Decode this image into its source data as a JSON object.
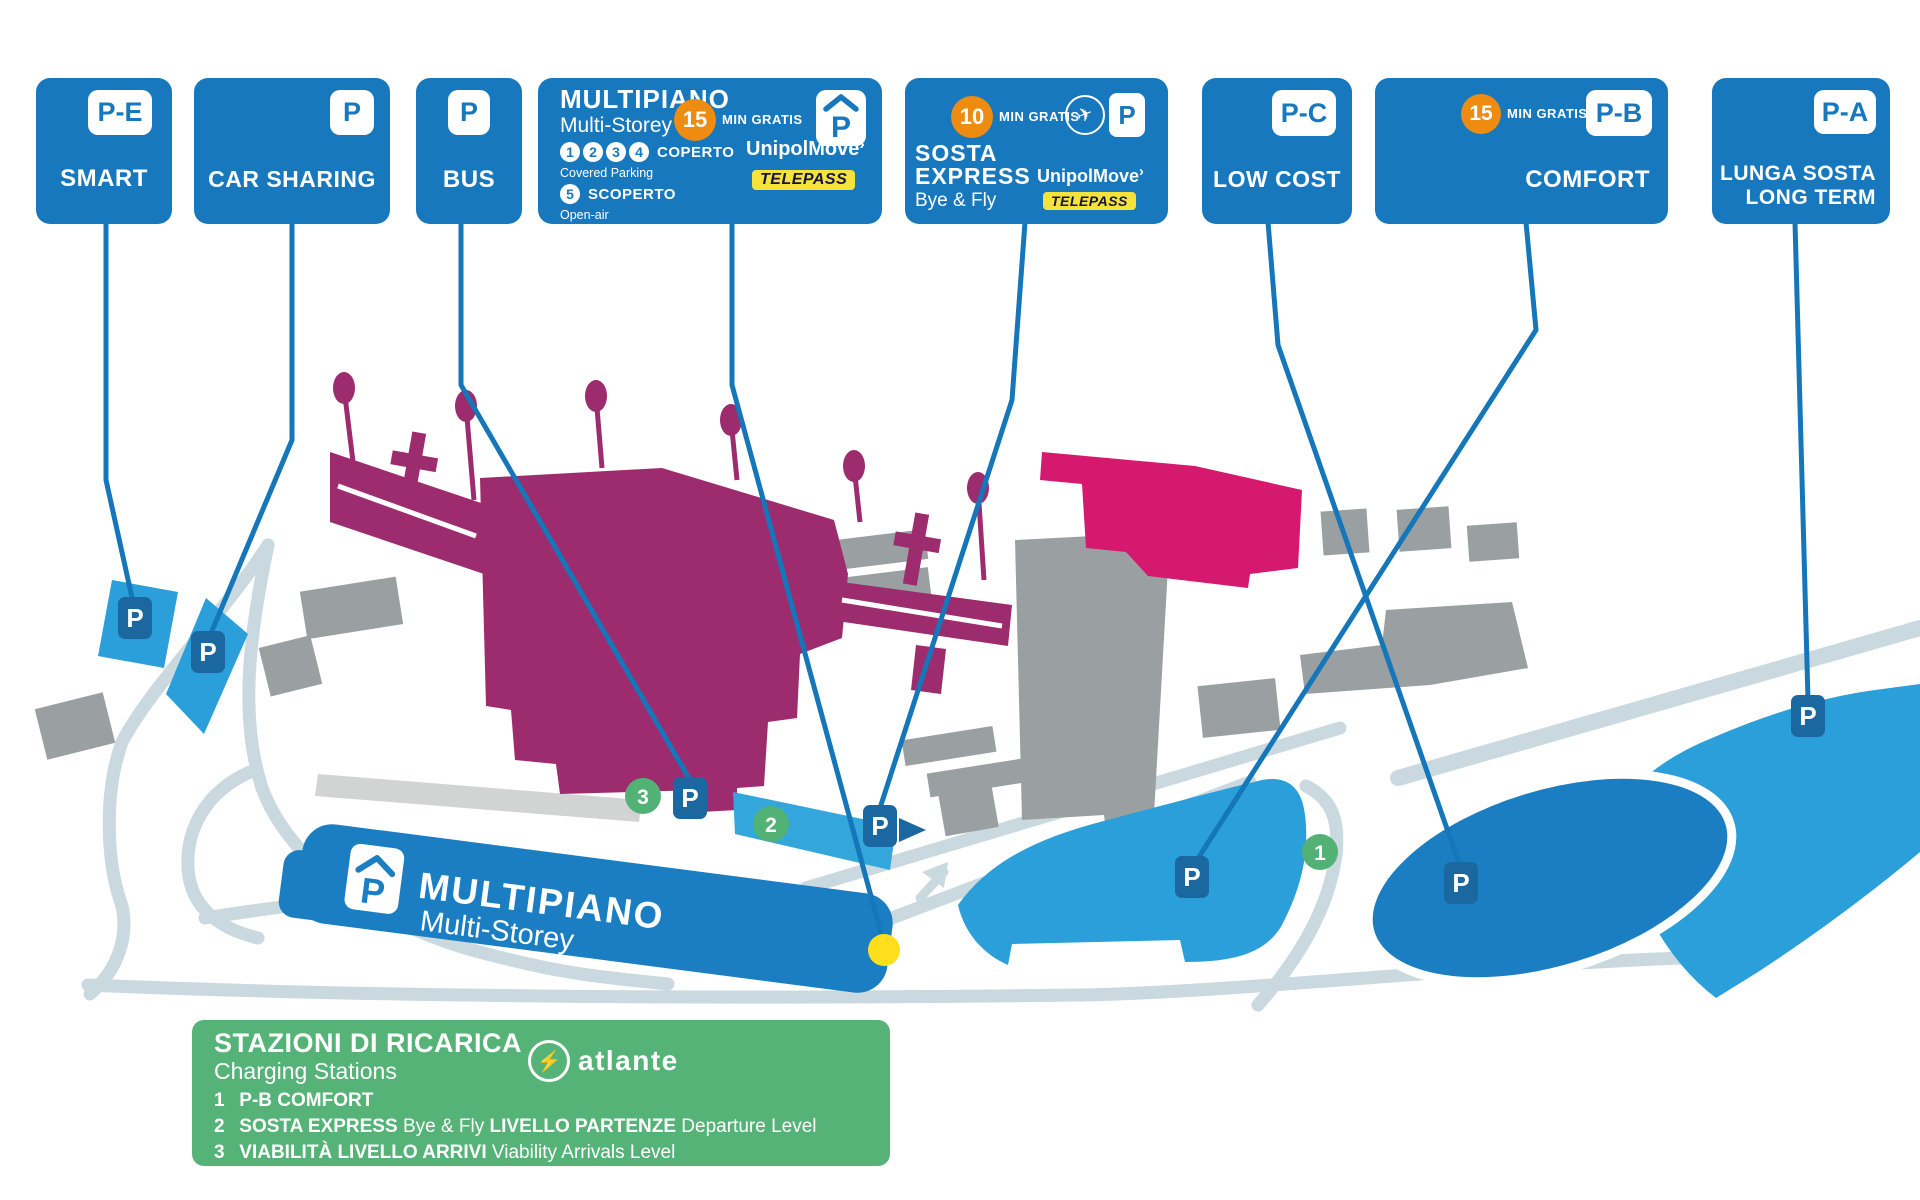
{
  "colors": {
    "card_blue": "#1878be",
    "map_mid_blue": "#1b7ec2",
    "map_light_blue": "#2b9fd9",
    "marker_blue": "#1b67a0",
    "terminal_magenta": "#9c2c6d",
    "building_pink": "#d4196e",
    "building_gray": "#9aa0a2",
    "road_gray": "#c9d9df",
    "green": "#52b175",
    "charging_box_green": "#56b377",
    "yellow_dot": "#ffdf1b",
    "orange": "#ee8b11",
    "telepass_yellow": "#f5e23b"
  },
  "cards": {
    "smart": {
      "badge": "P-E",
      "label": "SMART"
    },
    "car_sharing": {
      "badge": "P",
      "label": "CAR SHARING"
    },
    "bus": {
      "badge": "P",
      "label": "BUS"
    },
    "multipiano": {
      "title": "MULTIPIANO",
      "subtitle": "Multi-Storey",
      "minutes": "15",
      "min_gratis": "MIN GRATIS",
      "p": "P",
      "levels": [
        "1",
        "2",
        "3",
        "4"
      ],
      "covered_label": "COPERTO",
      "covered_sub": "Covered Parking",
      "open_level": "5",
      "open_label": "SCOPERTO",
      "open_sub": "Open-air",
      "unipolmove": "UnipolMove",
      "telepass": "TELEPASS"
    },
    "sosta_express": {
      "title1": "SOSTA",
      "title2": "EXPRESS",
      "subtitle": "Bye & Fly",
      "minutes": "10",
      "min_gratis": "MIN GRATIS",
      "p": "P",
      "unipolmove": "UnipolMove",
      "telepass": "TELEPASS"
    },
    "low_cost": {
      "badge": "P-C",
      "label": "LOW COST"
    },
    "comfort": {
      "badge": "P-B",
      "label": "COMFORT",
      "minutes": "15",
      "min_gratis": "MIN GRATIS"
    },
    "long_term": {
      "badge": "P-A",
      "label1": "LUNGA SOSTA",
      "label2": "LONG TERM"
    }
  },
  "map": {
    "p": "P",
    "multipiano_title": "MULTIPIANO",
    "multipiano_subtitle": "Multi-Storey",
    "station1": "1",
    "station2": "2",
    "station3": "3"
  },
  "charging_box": {
    "title": "STAZIONI DI RICARICA",
    "subtitle": "Charging Stations",
    "brand": "atlante",
    "items": [
      {
        "num": "1",
        "bold1": "P-B COMFORT",
        "normal1": "",
        "bold2": "",
        "normal2": ""
      },
      {
        "num": "2",
        "bold1": "SOSTA EXPRESS",
        "normal1": "Bye & Fly",
        "bold2": "LIVELLO PARTENZE",
        "normal2": "Departure Level"
      },
      {
        "num": "3",
        "bold1": "VIABILITÀ LIVELLO ARRIVI",
        "normal1": "Viability Arrivals Level",
        "bold2": "",
        "normal2": ""
      }
    ]
  }
}
